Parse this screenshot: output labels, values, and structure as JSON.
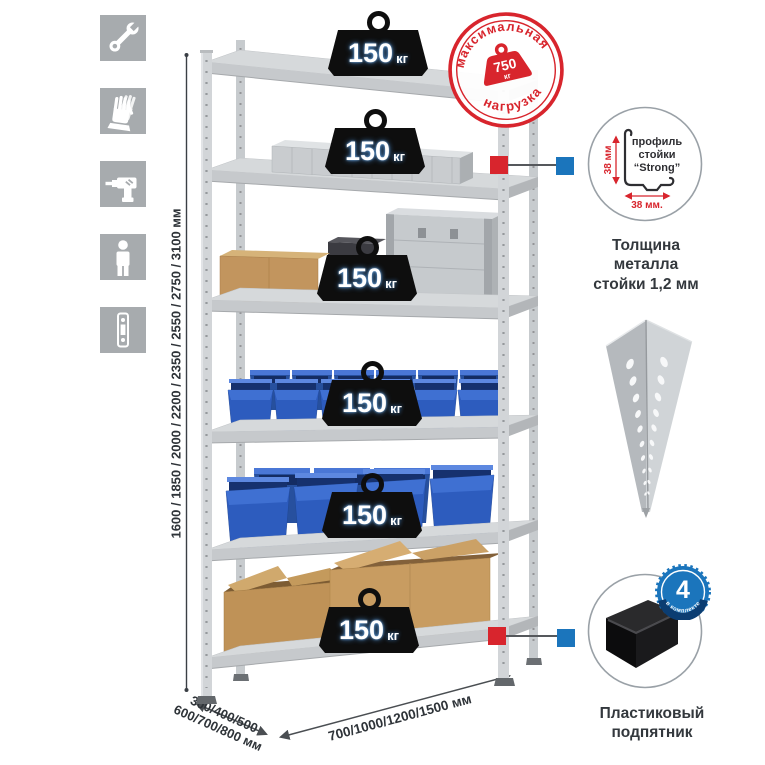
{
  "side_icons": [
    {
      "icon": "wrench-icon"
    },
    {
      "icon": "gloves-icon"
    },
    {
      "icon": "drill-icon"
    },
    {
      "icon": "person-icon"
    },
    {
      "icon": "rack-post-icon"
    }
  ],
  "dimensions": {
    "height": "1600 / 1850 / 2000 / 2200 / 2350 / 2550 / 2750 / 3100 мм",
    "depth_line1": "300/400/500",
    "depth_line2": "600/700/800 мм",
    "width": "700/1000/1200/1500 мм"
  },
  "max_load_stamp": {
    "arc_top": "максимальная",
    "arc_bottom": "нагрузка",
    "value": "750",
    "unit": "кг"
  },
  "shelf_loads": [
    {
      "value": "150",
      "unit": "кг"
    },
    {
      "value": "150",
      "unit": "кг"
    },
    {
      "value": "150",
      "unit": "кг"
    },
    {
      "value": "150",
      "unit": "кг"
    },
    {
      "value": "150",
      "unit": "кг"
    },
    {
      "value": "150",
      "unit": "кг"
    }
  ],
  "profile_detail": {
    "line1": "профиль",
    "line2": "стойки",
    "line3": "“Strong”",
    "dim_vertical": "38 мм",
    "dim_horizontal": "38 мм.",
    "caption_line1": "Толщина металла",
    "caption_line2": "стойки 1,2 мм"
  },
  "foot_detail": {
    "badge_value": "4",
    "badge_arc": "в комплекте",
    "caption_line1": "Пластиковый",
    "caption_line2": "подпятник"
  },
  "colors": {
    "accent_red": "#d8252d",
    "accent_blue": "#1b75bc",
    "bin_blue": "#2d5cbe",
    "metal_gray": "#ccd0d3",
    "icon_gray": "#a7abae",
    "badge_black": "#0e0e0e",
    "load_glow_blue": "#4a90d8"
  }
}
